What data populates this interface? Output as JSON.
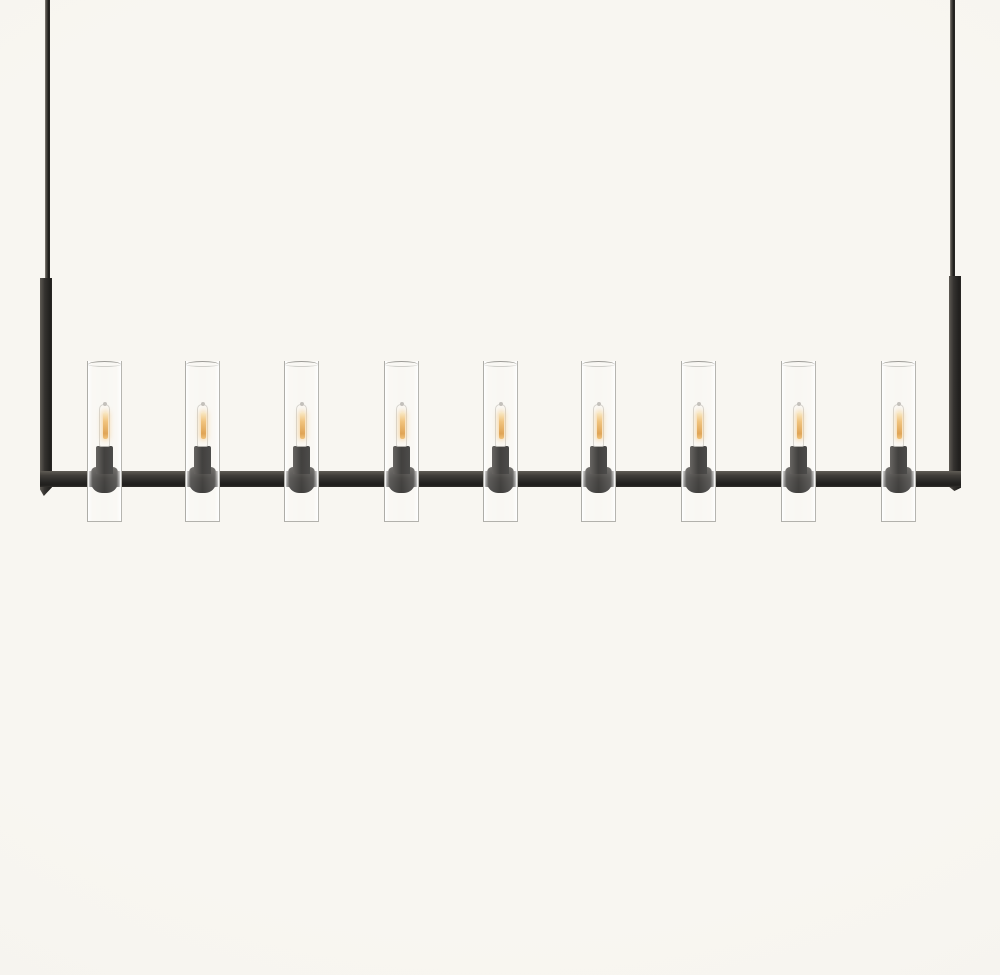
{
  "page": {
    "background_center_color": "#f8f6f1",
    "background_edge_color": "#f4f2ec"
  },
  "product_photo": {
    "subject": "nine-light linear chandelier, blackened-bronze rectangular frame with clear glass cylinder shades and lit tubular filament bulbs",
    "colors": {
      "metal_dark": "#201f1d",
      "metal_mid": "#34322f",
      "metal_highlight": "#5e5a54",
      "glass_edge": "#aeada8",
      "glass_fill": "#fbfaf6",
      "glow_bright": "#f8e7c0",
      "glow_mid": "#eeb967",
      "glow_core": "#da9438"
    },
    "frame": {
      "left_rod_x": 45,
      "right_rod_x": 950,
      "rod_width": 5,
      "arm_width": 12,
      "bar_top_y": 471,
      "bar_height": 16,
      "bar_left_x": 40,
      "bar_right_x": 961
    },
    "lights": {
      "count": 9,
      "centers_x": [
        104,
        202,
        301,
        401,
        500,
        598,
        698,
        798,
        898
      ],
      "glass_width": 35,
      "glass_top_y": 361,
      "glass_height": 161,
      "bulbs_lit": true
    }
  }
}
